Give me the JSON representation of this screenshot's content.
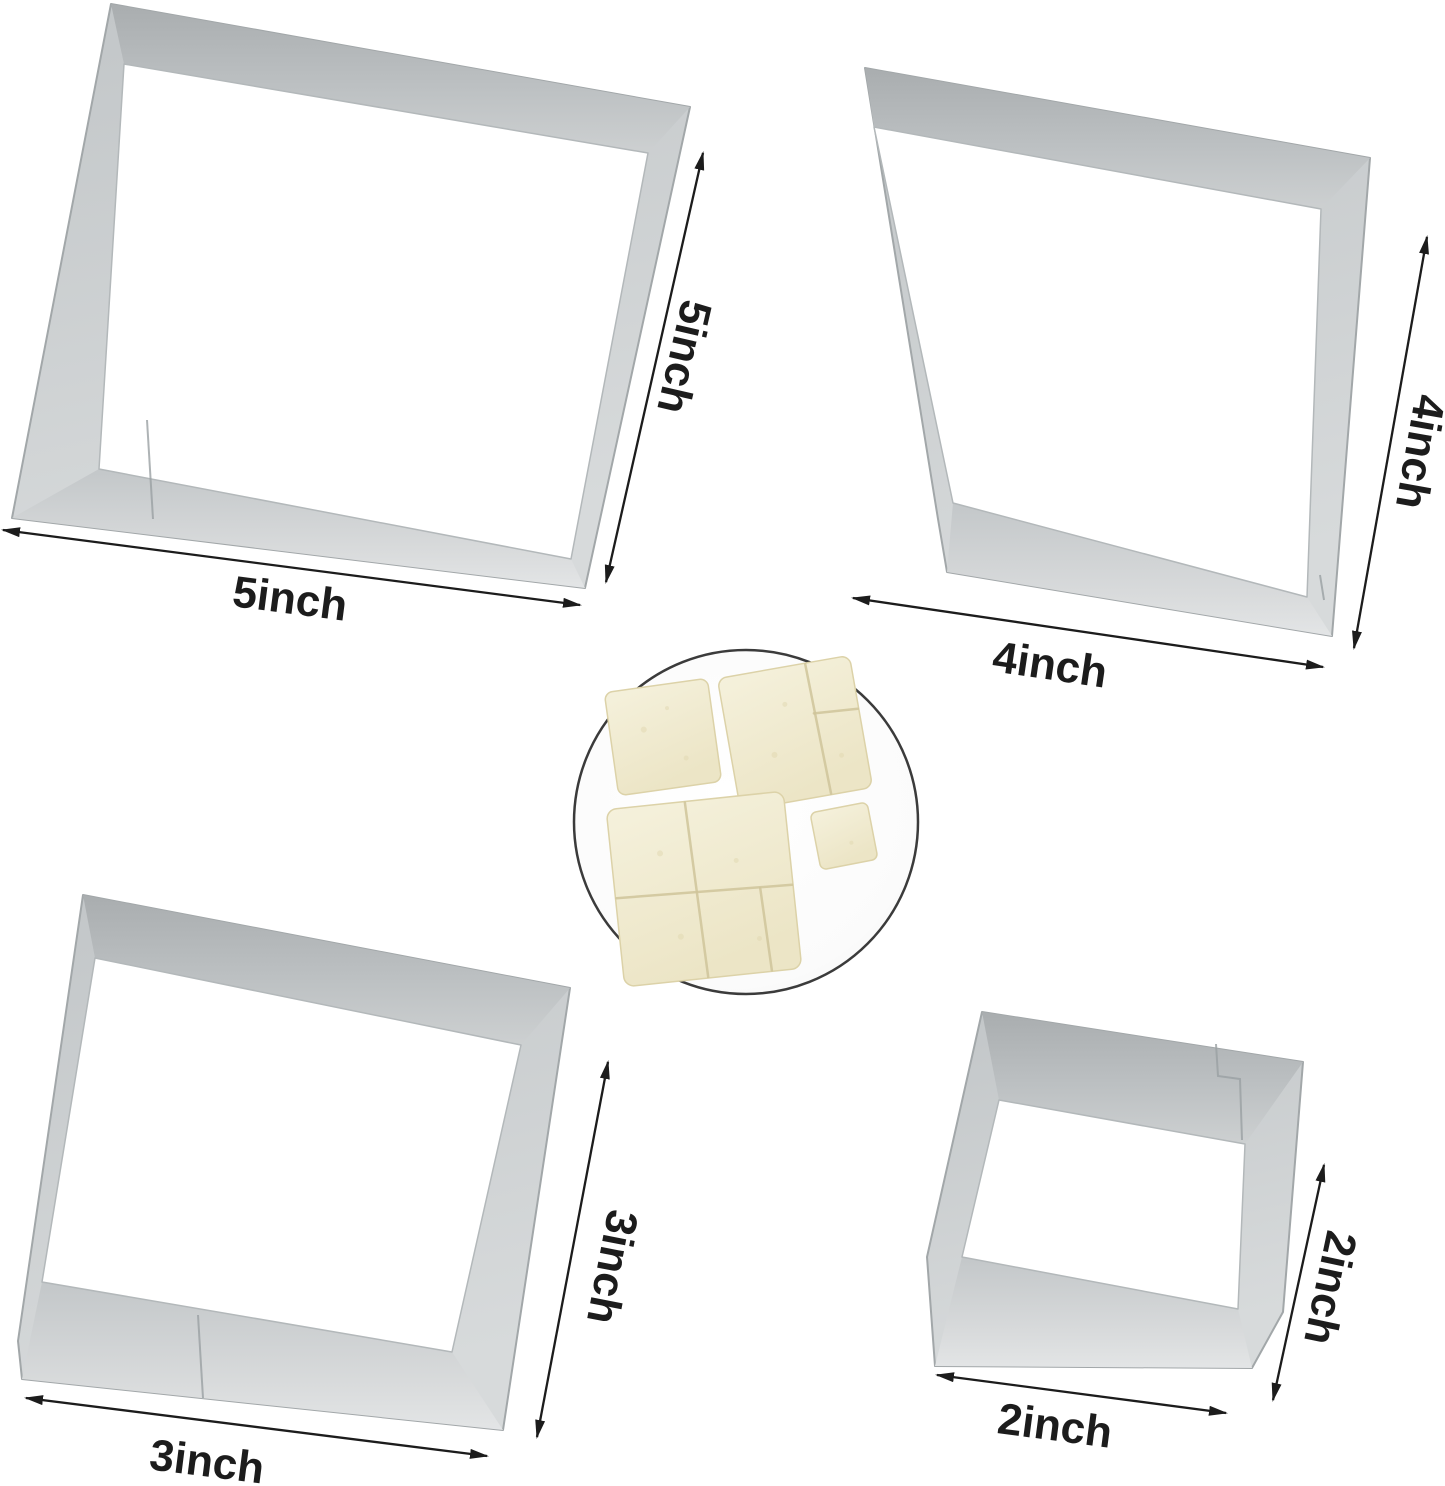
{
  "photo": {
    "background": "#ffffff"
  },
  "cutters": {
    "five": {
      "width_label": "5inch",
      "height_label": "5inch"
    },
    "four": {
      "width_label": "4inch",
      "height_label": "4inch"
    },
    "three": {
      "width_label": "3inch",
      "height_label": "3inch"
    },
    "two": {
      "width_label": "2inch",
      "height_label": "2inch"
    }
  },
  "colors": {
    "dimension": "#1c1c1c",
    "label_text": "#1c1c1c",
    "metal_edge": "#a2a7a9",
    "inset_border": "#3b3b3b",
    "bread": "#f2eed6"
  }
}
